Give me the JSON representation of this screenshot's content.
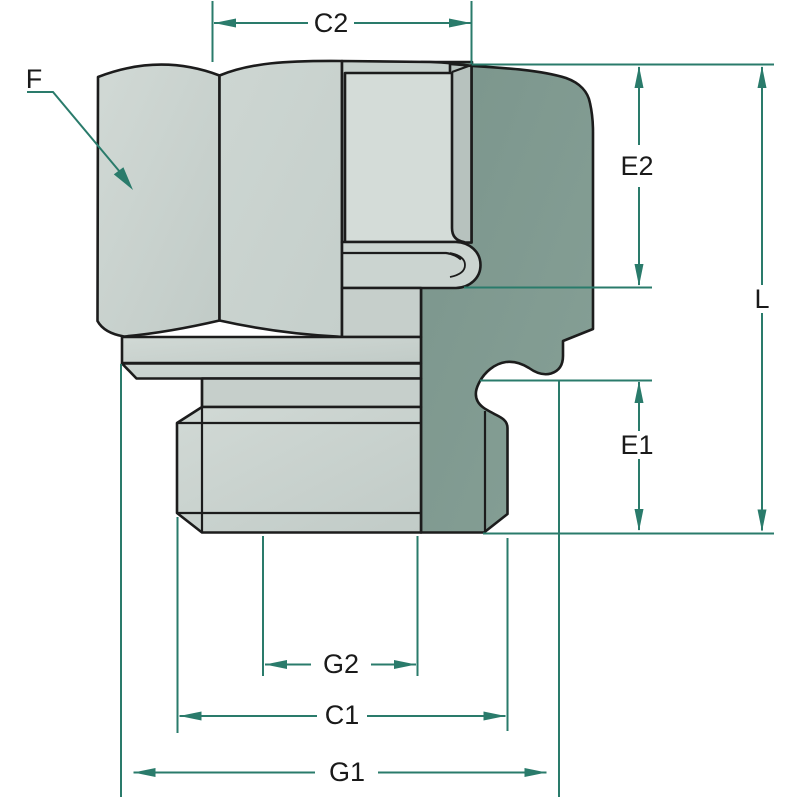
{
  "drawing": {
    "type": "technical-dimension-drawing",
    "subject": "hydraulic adapter fitting cross-section"
  },
  "labels": {
    "f": "F",
    "c2": "C2",
    "e2": "E2",
    "l": "L",
    "e1": "E1",
    "g2": "G2",
    "c1": "C1",
    "g1": "G1"
  },
  "colors": {
    "background": "#ffffff",
    "outline": "#1c1c1c",
    "dimension_teal": "#2a7b6b",
    "body_light_gray": "#c8d1cd",
    "body_section_dark": "#7e988e",
    "label_text": "#1a1a1a"
  }
}
